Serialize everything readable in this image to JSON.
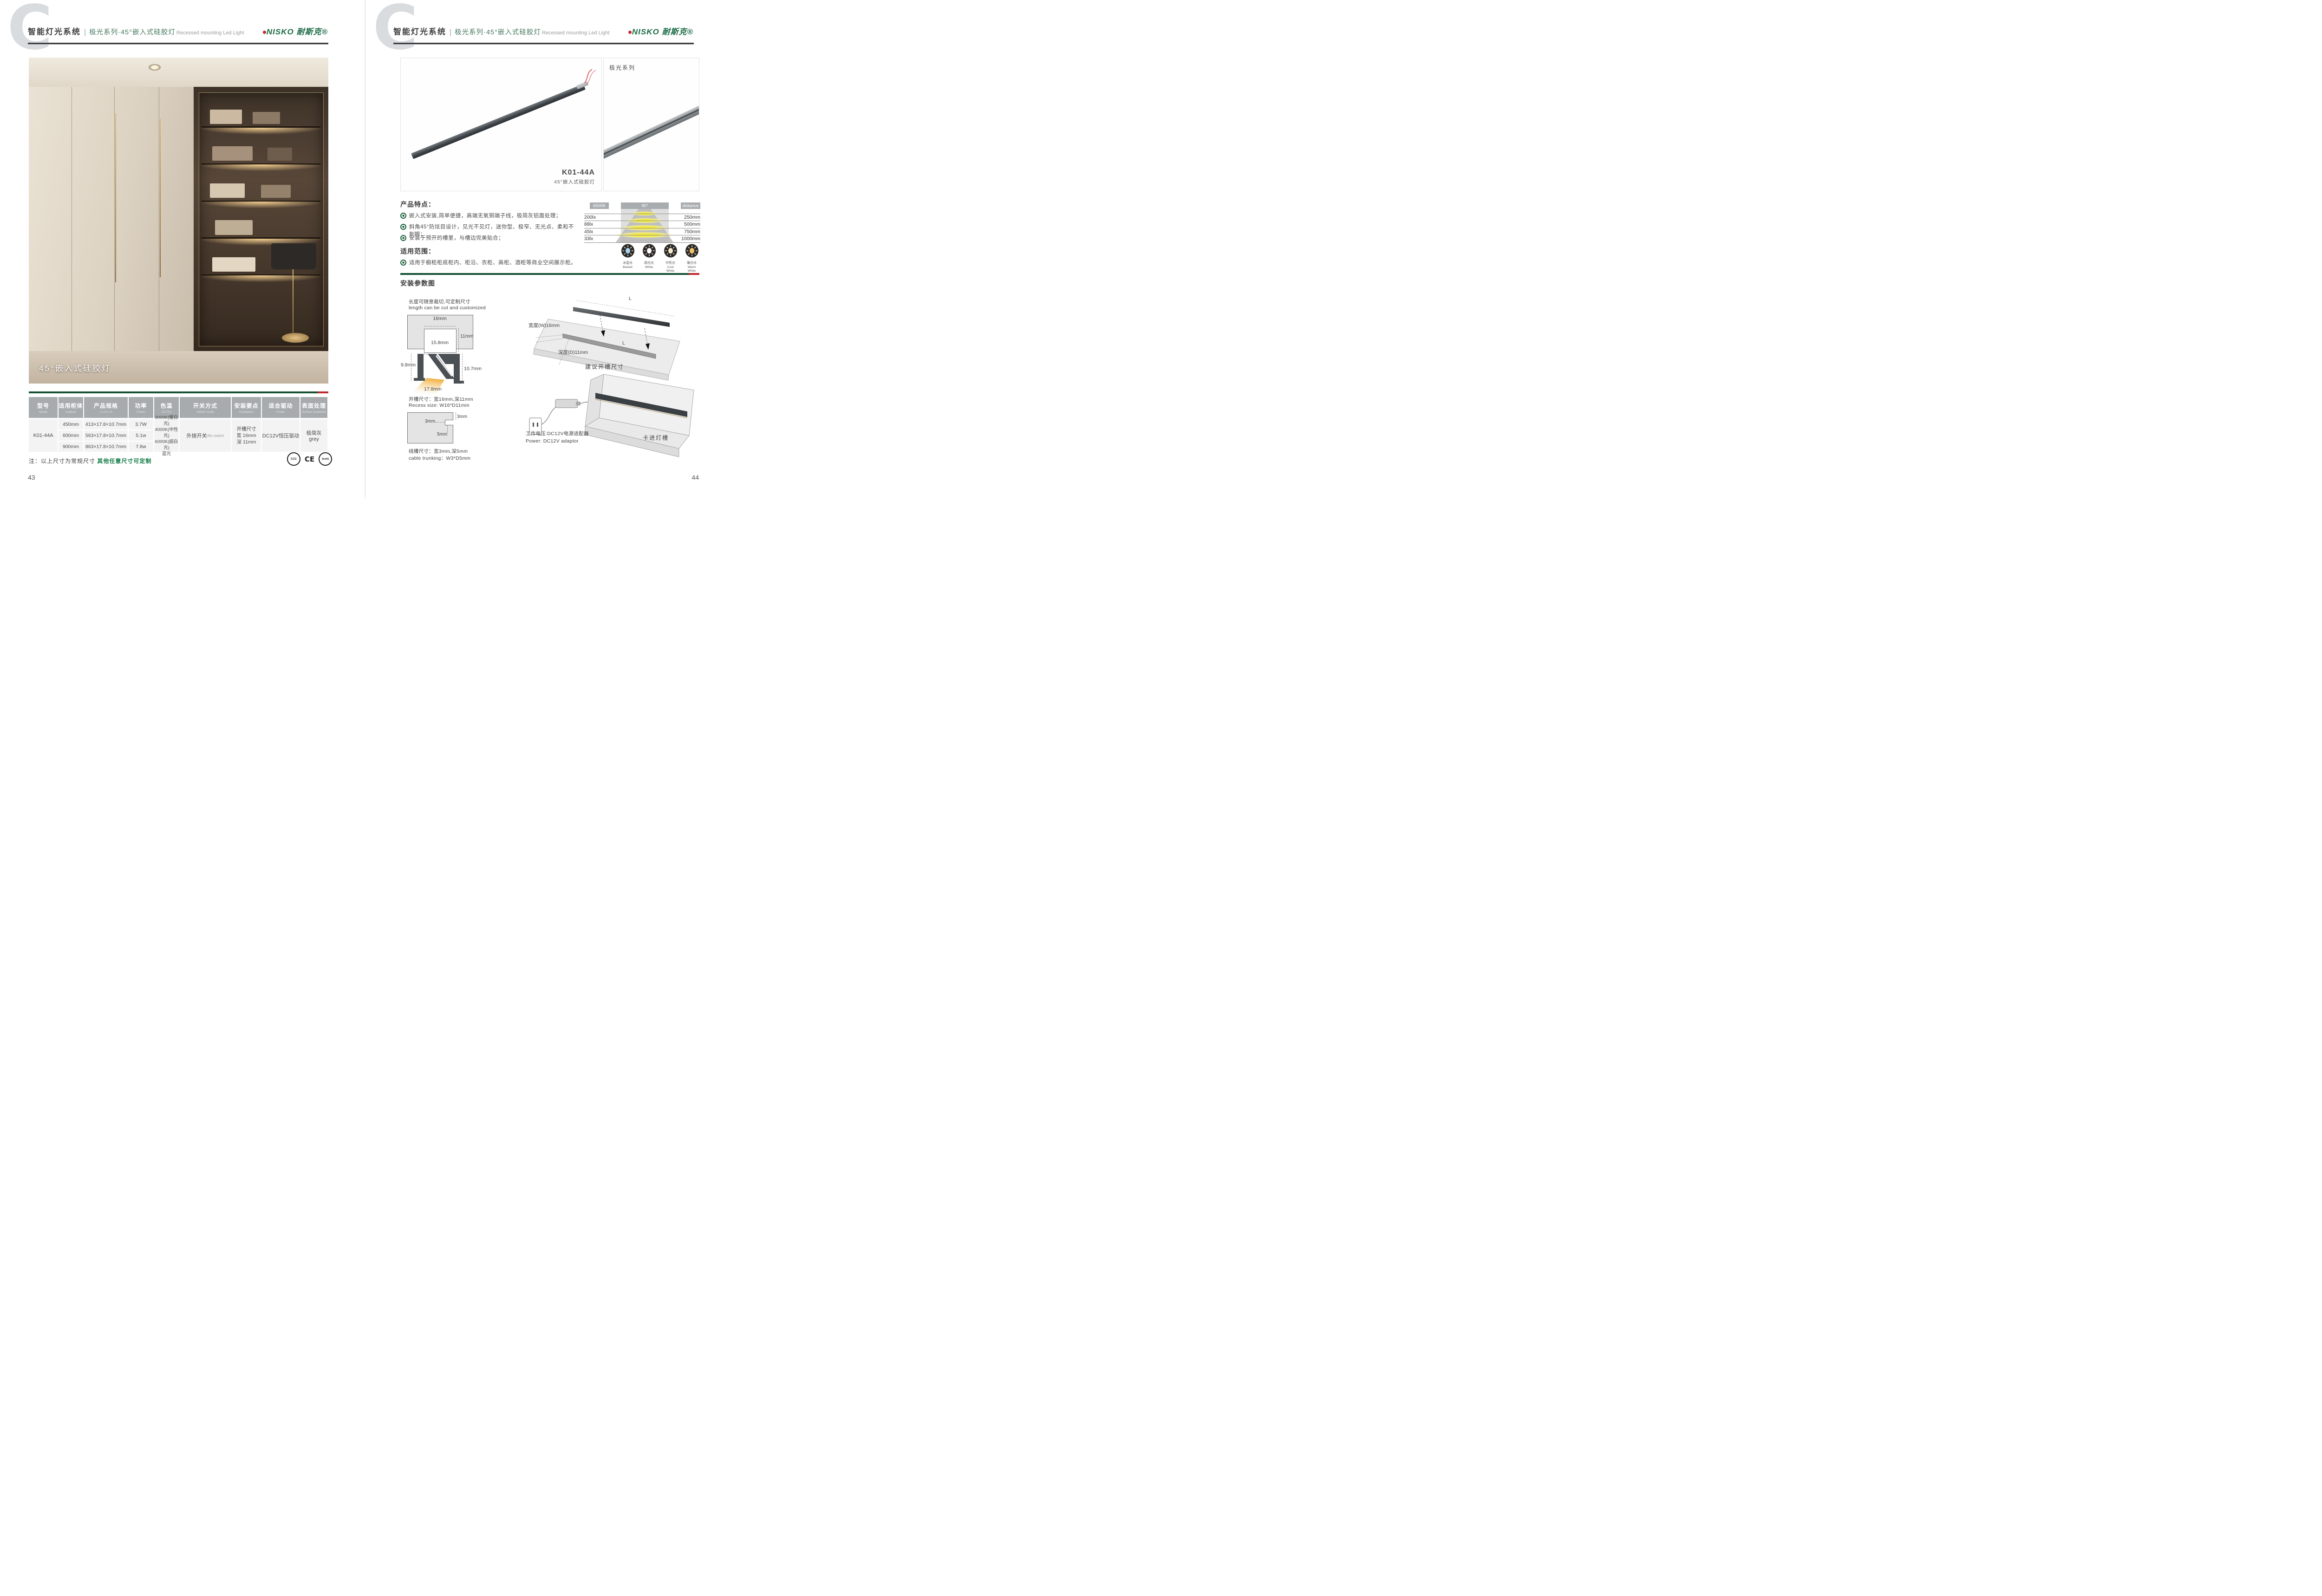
{
  "header": {
    "brand_section": "智能灯光系统",
    "divider": "|",
    "series_title": "极光系列·45°嵌入式硅胶灯",
    "subtitle_en": "Recessed mounting Led Light",
    "logo": "NISKO 耐斯克®"
  },
  "left_page": {
    "photo_caption": "45°嵌入式硅胶灯",
    "page_number": "43",
    "note_prefix": "注：以上尺寸为常规尺寸 ",
    "note_highlight": "其他任意尺寸可定制",
    "certs": [
      "CCC",
      "CE",
      "RoHS"
    ],
    "table": {
      "columns": [
        {
          "zh": "型号",
          "en": "Model"
        },
        {
          "zh": "适用柜体",
          "en": "Cabinet"
        },
        {
          "zh": "产品规格",
          "en": "L x D x H"
        },
        {
          "zh": "功率",
          "en": "Power"
        },
        {
          "zh": "色温",
          "en": "CCT(K)"
        },
        {
          "zh": "开关方式",
          "en": "Switch mode"
        },
        {
          "zh": "安装要点",
          "en": "Installation"
        },
        {
          "zh": "适合驱动",
          "en": "Power"
        },
        {
          "zh": "表面处理",
          "en": "Surface treatment"
        }
      ],
      "model": "K01-44A",
      "rows": [
        {
          "cabinet": "450mm",
          "spec": "413×17.8×10.7mm",
          "power": "3.7W"
        },
        {
          "cabinet": "600mm",
          "spec": "563×17.8×10.7mm",
          "power": "5.1w"
        },
        {
          "cabinet": "900mm",
          "spec": "863×17.8×10.7mm",
          "power": "7.8w"
        }
      ],
      "cct_lines": [
        "3000K(暖白光)",
        "4000K(中性光)",
        "6000K(超白光)",
        "蓝光"
      ],
      "switch_zh": "外接开关",
      "switch_en": "/No switch",
      "install_lines": [
        "开槽尺寸",
        "宽 16mm",
        "深 11mm"
      ],
      "driver": "DC12V恒压驱动",
      "surface_zh": "极简灰",
      "surface_en": "grey"
    }
  },
  "right_page": {
    "page_number": "44",
    "product": {
      "model": "K01-44A",
      "subtitle": "45°嵌入式硅胶灯",
      "series_tag": "极光系列"
    },
    "features": {
      "title": "产品特点：",
      "items": [
        "嵌入式安装,简单便捷，高端无氧铜端子线，极简灰铝面处理；",
        "斜角45°防炫目设计，见光不见灯，迷你型、极窄、无光点、柔和不刺眼；",
        "安装于预开的槽里，与槽边完美贴合；"
      ]
    },
    "scope": {
      "title": "适用范围：",
      "text": "适用于橱柜柜底柜内、柜沿、衣柜、高柜、酒柜等商业空间展示柜。"
    },
    "photometric": {
      "cct": "6500K",
      "angle": "90°",
      "distance_label": "distance",
      "rows": [
        {
          "lux": "200lx",
          "distance": "250mm"
        },
        {
          "lux": "88lx",
          "distance": "500mm"
        },
        {
          "lux": "45lx",
          "distance": "750mm"
        },
        {
          "lux": "33lx",
          "distance": "1000mm"
        }
      ]
    },
    "cct_icons": [
      {
        "zh": "冰蓝光",
        "en": "Basket",
        "color": "#a9d3ef"
      },
      {
        "zh": "超白光",
        "en": "White",
        "color": "#ffffff"
      },
      {
        "zh": "中性光",
        "en": "Cool White",
        "color": "#f7ebcb"
      },
      {
        "zh": "暖白光",
        "en": "Warm White",
        "color": "#f2c469"
      }
    ],
    "install": {
      "title": "安装参数图",
      "cut_note_zh": "长度可随意裁切,可定制尺寸",
      "cut_note_en": "length can be cut and customized",
      "recess": {
        "top": "16mm",
        "depth": "11mm",
        "bottom": "15.8mm"
      },
      "profile": {
        "left": "9.8mm",
        "right": "10.7mm",
        "bottom": "17.8mm"
      },
      "recess_size_zh": "开槽尺寸：宽16mm,深11mm",
      "recess_size_en": "Recess size: W16*D11mm",
      "trunk": {
        "w": "3mm",
        "h": "3mm",
        "d": "5mm"
      },
      "trunk_zh": "线槽尺寸：宽3mm,深5mm",
      "trunk_en": "cable trunking：W3*D5mm",
      "panel": {
        "l_top": "L",
        "l_groove": "L",
        "width_label": "宽度(W)16mm",
        "depth_label": "深度(D)11mm",
        "caption": "建议开槽尺寸"
      },
      "power_zh": "工作电压:DC12V电源适配器",
      "power_en": "Power: DC12V adaptor",
      "clip_label": "卡进灯槽"
    }
  }
}
